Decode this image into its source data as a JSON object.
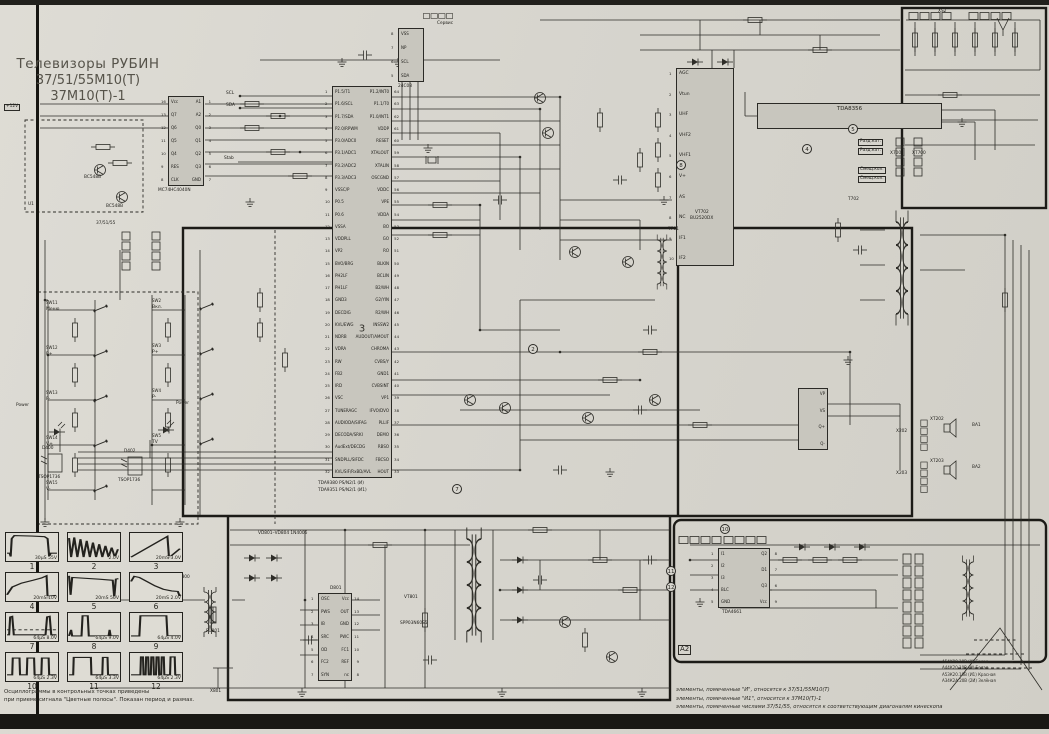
{
  "title": {
    "line1": "Телевизоры РУБИН",
    "line2": "37/51/55М10(Т)",
    "line3": "37М10(Т)-1"
  },
  "ics": {
    "counter": {
      "name": "MC74HC4040N",
      "left_pins": [
        {
          "n": "16",
          "label": "Vcc"
        },
        {
          "n": "13",
          "label": "Q7"
        },
        {
          "n": "12",
          "label": "Q6"
        },
        {
          "n": "11",
          "label": "Q5"
        },
        {
          "n": "10",
          "label": "Q4"
        },
        {
          "n": "9",
          "label": "RES"
        },
        {
          "n": "8",
          "label": "CLK"
        }
      ],
      "right_pins": [
        {
          "n": "1",
          "label": "A1"
        },
        {
          "n": "2",
          "label": "A2"
        },
        {
          "n": "3",
          "label": "Q0"
        },
        {
          "n": "4",
          "label": "Q1"
        },
        {
          "n": "5",
          "label": "Q2"
        },
        {
          "n": "6",
          "label": "Q3"
        },
        {
          "n": "7",
          "label": "GND"
        }
      ]
    },
    "eeprom": {
      "name": "24C08",
      "pins": [
        {
          "n": "8",
          "label": "VSS"
        },
        {
          "n": "7",
          "label": "NP"
        },
        {
          "n": "6",
          "label": "SCL"
        },
        {
          "n": "5",
          "label": "SDA"
        }
      ]
    },
    "uoc": {
      "name_line1": "TDA9380 PS/N2/1 (И)",
      "name_line2": "TDA9351 PS/N2/1 (И1)",
      "big_label": "3",
      "left_pins": [
        {
          "n": "1",
          "label": "P1.5/T1"
        },
        {
          "n": "2",
          "label": "P1.6/SCL"
        },
        {
          "n": "3",
          "label": "P1.7/SDA"
        },
        {
          "n": "4",
          "label": "P2.0/RPWM"
        },
        {
          "n": "5",
          "label": "P3.0/ADC0"
        },
        {
          "n": "6",
          "label": "P3.1/ADC1"
        },
        {
          "n": "7",
          "label": "P3.2/ADC2"
        },
        {
          "n": "8",
          "label": "P3.3/ADC3"
        },
        {
          "n": "9",
          "label": "VSSC/P"
        },
        {
          "n": "10",
          "label": "P0.5"
        },
        {
          "n": "11",
          "label": "P0.6"
        },
        {
          "n": "12",
          "label": "VSSA"
        },
        {
          "n": "13",
          "label": "VDDPLL"
        },
        {
          "n": "14",
          "label": "VP2"
        },
        {
          "n": "15",
          "label": "BVO/BRG"
        },
        {
          "n": "16",
          "label": "PH2LF"
        },
        {
          "n": "17",
          "label": "PH1LF"
        },
        {
          "n": "18",
          "label": "GND3"
        },
        {
          "n": "19",
          "label": "DECDIG"
        },
        {
          "n": "20",
          "label": "KVL/EWG"
        },
        {
          "n": "21",
          "label": "NDRB"
        },
        {
          "n": "22",
          "label": "VDRA"
        },
        {
          "n": "23",
          "label": "RW"
        },
        {
          "n": "24",
          "label": "FB2"
        },
        {
          "n": "25",
          "label": "IRD"
        },
        {
          "n": "26",
          "label": "VSC"
        },
        {
          "n": "27",
          "label": "TUNERAGC"
        },
        {
          "n": "28",
          "label": "AUDIODA/SIFAG"
        },
        {
          "n": "29",
          "label": "DECODA/SRKI"
        },
        {
          "n": "30",
          "label": "AudExt/DECDG"
        },
        {
          "n": "31",
          "label": "SNDPLL/SIFDC"
        },
        {
          "n": "32",
          "label": "KVL/SIF/RxBD/AVL"
        }
      ],
      "right_pins": [
        {
          "n": "64",
          "label": "P1.2/INT0"
        },
        {
          "n": "63",
          "label": "P1.1/T0"
        },
        {
          "n": "62",
          "label": "P1.0/INT1"
        },
        {
          "n": "61",
          "label": "VDDP"
        },
        {
          "n": "60",
          "label": "RESET"
        },
        {
          "n": "59",
          "label": "XTALOUT"
        },
        {
          "n": "58",
          "label": "XTALIN"
        },
        {
          "n": "57",
          "label": "OSCGND"
        },
        {
          "n": "56",
          "label": "VDDC"
        },
        {
          "n": "55",
          "label": "VPE"
        },
        {
          "n": "54",
          "label": "VDDA"
        },
        {
          "n": "53",
          "label": "BO"
        },
        {
          "n": "52",
          "label": "GO"
        },
        {
          "n": "51",
          "label": "RO"
        },
        {
          "n": "50",
          "label": "BLKIN"
        },
        {
          "n": "49",
          "label": "BCLIN"
        },
        {
          "n": "48",
          "label": "B2/WH"
        },
        {
          "n": "47",
          "label": "G2/YIN"
        },
        {
          "n": "46",
          "label": "R2/WH"
        },
        {
          "n": "45",
          "label": "INSSW2"
        },
        {
          "n": "44",
          "label": "AUDOUT/AMOUT"
        },
        {
          "n": "43",
          "label": "CHROMA"
        },
        {
          "n": "42",
          "label": "CVBS/Y"
        },
        {
          "n": "41",
          "label": "GND1"
        },
        {
          "n": "40",
          "label": "CVBSINT"
        },
        {
          "n": "39",
          "label": "VP1"
        },
        {
          "n": "38",
          "label": "IFVO/DVO"
        },
        {
          "n": "37",
          "label": "PLLIF"
        },
        {
          "n": "36",
          "label": "DEMO"
        },
        {
          "n": "35",
          "label": "RBSO"
        },
        {
          "n": "34",
          "label": "FBCSO"
        },
        {
          "n": "33",
          "label": "HOUT"
        }
      ]
    },
    "tuner": {
      "pins": [
        {
          "n": "1",
          "label": "AGC"
        },
        {
          "n": "2",
          "label": "Vtun"
        },
        {
          "n": "3",
          "label": "UHF"
        },
        {
          "n": "4",
          "label": "VHF2"
        },
        {
          "n": "5",
          "label": "VHF1"
        },
        {
          "n": "6",
          "label": "V+"
        },
        {
          "n": "7",
          "label": "AS"
        },
        {
          "n": "8",
          "label": "NC"
        },
        {
          "n": "9",
          "label": "IF1"
        },
        {
          "n": "10",
          "label": "IF2"
        }
      ]
    },
    "vertical": {
      "name": "TDA8356",
      "pins": [
        {
          "n": "1",
          "label": "Vi+"
        },
        {
          "n": "2",
          "label": "Vi-"
        },
        {
          "n": "3",
          "label": "Vp"
        },
        {
          "n": "4",
          "label": "OutB"
        },
        {
          "n": "5",
          "label": "Gnd"
        },
        {
          "n": "6",
          "label": "Vfb"
        },
        {
          "n": "7",
          "label": "OutA"
        },
        {
          "n": "8",
          "label": "Guard"
        },
        {
          "n": "9",
          "label": "VoutB"
        }
      ]
    },
    "smps": {
      "designator": "D801",
      "left_pins": [
        {
          "n": "1",
          "label": "OSC"
        },
        {
          "n": "2",
          "label": "PWS"
        },
        {
          "n": "3",
          "label": "IB"
        },
        {
          "n": "4",
          "label": "SRC"
        },
        {
          "n": "5",
          "label": "OD"
        },
        {
          "n": "6",
          "label": "FC2"
        },
        {
          "n": "7",
          "label": "SYN"
        }
      ],
      "right_pins": [
        {
          "n": "14",
          "label": "Vcc"
        },
        {
          "n": "13",
          "label": "OUT"
        },
        {
          "n": "12",
          "label": "GND"
        },
        {
          "n": "11",
          "label": "PWC"
        },
        {
          "n": "10",
          "label": "FC1"
        },
        {
          "n": "9",
          "label": "REF"
        },
        {
          "n": "8",
          "label": "nc"
        }
      ]
    },
    "delay": {
      "name": "TDA4661",
      "left_pins": [
        {
          "n": "1",
          "label": "I1"
        },
        {
          "n": "2",
          "label": "I2"
        },
        {
          "n": "3",
          "label": "I3"
        },
        {
          "n": "4",
          "label": "BLC"
        },
        {
          "n": "5",
          "label": "GND"
        }
      ],
      "right_pins": [
        {
          "n": "8",
          "label": "Q2"
        },
        {
          "n": "7",
          "label": "D1"
        },
        {
          "n": "6",
          "label": "Q3"
        },
        {
          "n": "9",
          "label": "Vcc"
        }
      ]
    },
    "audio": {
      "pins": [
        {
          "n": "1",
          "label": "VP"
        },
        {
          "n": "2",
          "label": "VS"
        },
        {
          "n": "3",
          "label": "Q+"
        },
        {
          "n": "4",
          "label": "Q-"
        }
      ]
    }
  },
  "keyboard": {
    "left": [
      {
        "ref": "SW11",
        "label": "Меню"
      },
      {
        "ref": "SW12",
        "label": "P+"
      },
      {
        "ref": "SW13",
        "label": "P-"
      },
      {
        "ref": "SW14",
        "label": "V+"
      },
      {
        "ref": "SW15",
        "label": "V-"
      }
    ],
    "right": [
      {
        "ref": "SW2",
        "label": "Вкл."
      },
      {
        "ref": "SW3",
        "label": "P+"
      },
      {
        "ref": "SW4",
        "label": "P-"
      },
      {
        "ref": "SW5",
        "label": "TV"
      }
    ]
  },
  "labels": {
    "plus12v": "+12V",
    "scl": "SCL",
    "sda": "SDA",
    "stab": "Stab",
    "service": "Сервис",
    "power1": "Power",
    "power2": "Power",
    "d400": "D400",
    "tsop1": "TSOP1736",
    "d402": "D402",
    "tsop2": "TSOP1736",
    "vt702": "VT702",
    "bu2520": "BU2520DX",
    "t701": "Т701",
    "t702": "Т702",
    "bridge": "VD801–VD804  1N4006",
    "vt801": "VT801",
    "mosfet": "SPP03N60S5",
    "fu801": "FU801",
    "x801": "Х801",
    "xt800": "ХТ800",
    "ba1": "ВА1",
    "ba2": "ВА2",
    "xt202": "ХТ202",
    "xt203": "ХТ203",
    "x202": "Х202",
    "x203": "Х203",
    "x700": "Х700",
    "xt700": "ХТ700",
    "xs2": "XS2",
    "a2": "A2",
    "u1": "U1",
    "u1_models": "37/51/55",
    "razd1": "Разд.кат.",
    "razd2": "Разд.кат.",
    "smesh1": "Смещ.кол.",
    "smesh2": "Смещ.кол.",
    "vt_u1a": "BC548B",
    "vt_u1b": "BC548B"
  },
  "tps": [
    "2",
    "4",
    "5",
    "7",
    "8",
    "10",
    "11",
    "12"
  ],
  "oscillograms": {
    "items": [
      {
        "n": "1",
        "label": "30µS 55V",
        "shape": "vsync_pulse"
      },
      {
        "n": "2",
        "label": "2.0V",
        "shape": "saw_teeth"
      },
      {
        "n": "3",
        "label": "20mS 3.0V",
        "shape": "ramp"
      },
      {
        "n": "4",
        "label": "20mS 10V",
        "shape": "slow_rise"
      },
      {
        "n": "5",
        "label": "20mS 50V",
        "shape": "flat_spikes"
      },
      {
        "n": "6",
        "label": "20mS 2.0V",
        "shape": "hump"
      },
      {
        "n": "7",
        "label": "64µS 8.0V",
        "shape": "pulse_dashed"
      },
      {
        "n": "8",
        "label": "64µS 9.0V",
        "shape": "pulse_narrow"
      },
      {
        "n": "9",
        "label": "64µS 4.0V",
        "shape": "pulse_wide"
      },
      {
        "n": "10",
        "label": "64µS 2.3V",
        "shape": "pulses3"
      },
      {
        "n": "11",
        "label": "64µS 3.3V",
        "shape": "wide_narrow"
      },
      {
        "n": "12",
        "label": "64µS 2.3V",
        "shape": "burst"
      }
    ],
    "note1": "Осциллограммы в контрольных точках приведены",
    "note2": "при приеме сигнала \"Цветные полосы\".  Показан период и размах."
  },
  "legend": [
    "элементы, помеченные \"И\", относятся к 37/51/55М10(Т)",
    "элементы, помеченные \"И1\", относятся к 37М10(Т)-1",
    "элементы, помеченные числами 37/51/55, относятся к соответствующим диагоналям кинескопа"
  ],
  "kinwires": [
    "А54К90.10В  (И)  Белая",
    "А44К20.10В  (И)  Белая",
    "А53К20.10В  (И1)  Красная",
    "А34К2А.20В  (2И)  Зелёная"
  ]
}
